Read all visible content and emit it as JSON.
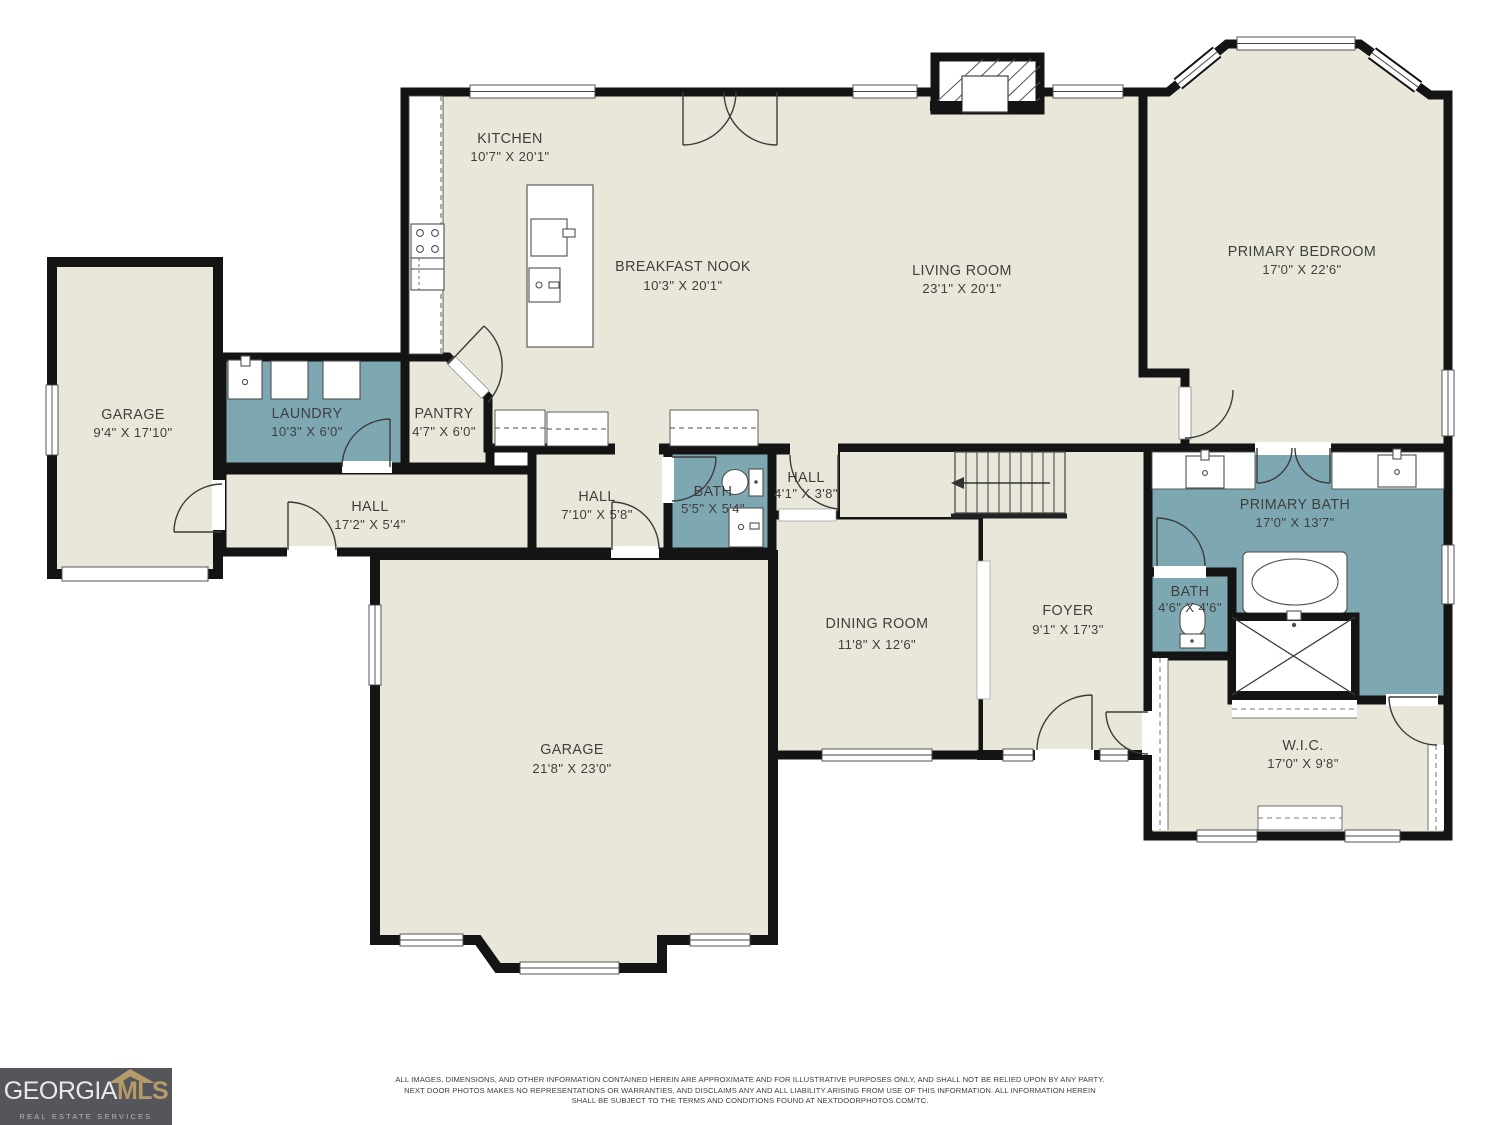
{
  "palette": {
    "background": "#ffffff",
    "floor": "#e9e7d9",
    "wet_room": "#7ea8b1",
    "wall": "#141414",
    "fixture_line": "#4e4e4e",
    "label_text": "#3f3f3f",
    "logo_bg": "#54565c",
    "logo_gold": "#b69b68",
    "logo_tagline": "#b4b6ba"
  },
  "rooms": [
    {
      "id": "kitchen",
      "name": "KITCHEN",
      "dims": "10'7\" X 20'1\""
    },
    {
      "id": "breakfast-nook",
      "name": "BREAKFAST NOOK",
      "dims": "10'3\" X 20'1\""
    },
    {
      "id": "living-room",
      "name": "LIVING ROOM",
      "dims": "23'1\" X 20'1\""
    },
    {
      "id": "primary-bedroom",
      "name": "PRIMARY BEDROOM",
      "dims": "17'0\" X 22'6\""
    },
    {
      "id": "garage-left",
      "name": "GARAGE",
      "dims": "9'4\" X 17'10\""
    },
    {
      "id": "laundry",
      "name": "LAUNDRY",
      "dims": "10'3\" X 6'0\""
    },
    {
      "id": "pantry",
      "name": "PANTRY",
      "dims": "4'7\" X 6'0\""
    },
    {
      "id": "hall-west",
      "name": "HALL",
      "dims": "17'2\" X 5'4\""
    },
    {
      "id": "hall-center",
      "name": "HALL",
      "dims": "7'10\" X 5'8\""
    },
    {
      "id": "bath-hall",
      "name": "BATH",
      "dims": "5'5\" X 5'4\""
    },
    {
      "id": "hall-small",
      "name": "HALL",
      "dims": "4'1\" X 3'8\""
    },
    {
      "id": "dining-room",
      "name": "DINING ROOM",
      "dims": "11'8\" X 12'6\""
    },
    {
      "id": "foyer",
      "name": "FOYER",
      "dims": "9'1\" X 17'3\""
    },
    {
      "id": "primary-bath",
      "name": "PRIMARY BATH",
      "dims": "17'0\" X 13'7\""
    },
    {
      "id": "bath-toilet",
      "name": "BATH",
      "dims": "4'6\" X 4'6\""
    },
    {
      "id": "wic",
      "name": "W.I.C.",
      "dims": "17'0\" X 9'8\""
    },
    {
      "id": "garage-main",
      "name": "GARAGE",
      "dims": "21'8\" X 23'0\""
    }
  ],
  "logo": {
    "brand": "GEORGIA",
    "suffix": "MLS",
    "tagline": "REAL ESTATE SERVICES"
  },
  "disclaimer": {
    "line1": "ALL IMAGES, DIMENSIONS, AND OTHER INFORMATION CONTAINED HEREIN ARE APPROXIMATE AND FOR ILLUSTRATIVE PURPOSES ONLY, AND SHALL NOT BE RELIED UPON BY ANY PARTY.",
    "line2": "NEXT DOOR PHOTOS MAKES NO REPRESENTATIONS OR WARRANTIES, AND DISCLAIMS ANY AND ALL LIABILITY ARISING FROM USE OF THIS INFORMATION. ALL INFORMATION HEREIN",
    "line3": "SHALL BE SUBJECT TO THE TERMS AND CONDITIONS FOUND AT NEXTDOORPHOTOS.COM/TC."
  }
}
